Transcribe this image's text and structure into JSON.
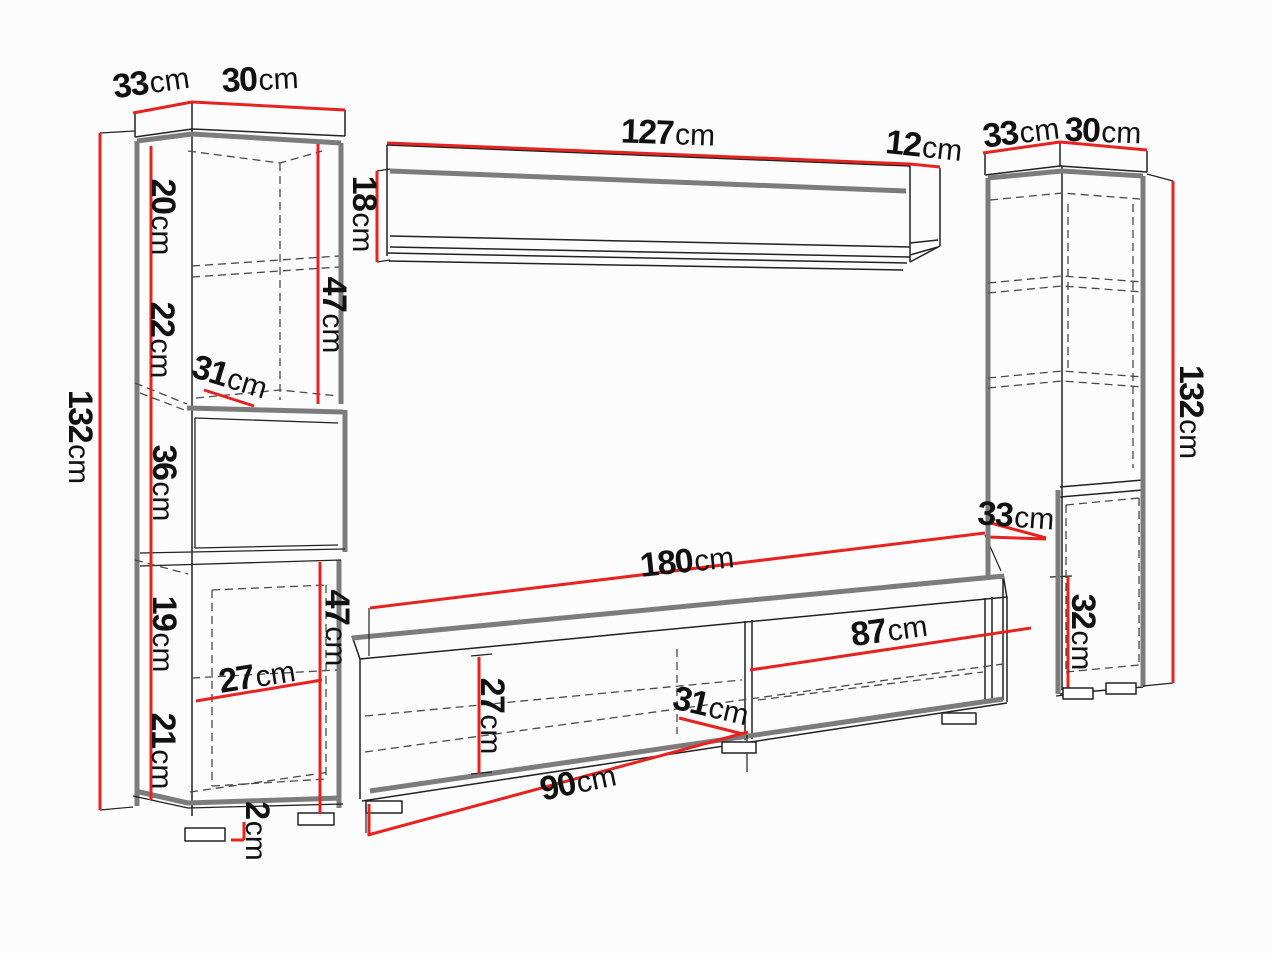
{
  "diagram": {
    "description": "Wall unit furniture dimension drawing",
    "colors": {
      "dimension_line": "#e8231f",
      "outline": "#222222",
      "shadow_edge": "#7c7c7c",
      "background": "#fcfcfc"
    }
  },
  "labels": {
    "left": {
      "top_depth": {
        "value": "33",
        "unit": "cm"
      },
      "top_width": {
        "value": "30",
        "unit": "cm"
      },
      "height": {
        "value": "132",
        "unit": "cm"
      },
      "shelf20": {
        "value": "20",
        "unit": "cm"
      },
      "shelf22": {
        "value": "22",
        "unit": "cm"
      },
      "depth31": {
        "value": "31",
        "unit": "cm"
      },
      "shelf36": {
        "value": "36",
        "unit": "cm"
      },
      "upper47": {
        "value": "47",
        "unit": "cm"
      },
      "shelf19": {
        "value": "19",
        "unit": "cm"
      },
      "depth27": {
        "value": "27",
        "unit": "cm"
      },
      "shelf21": {
        "value": "21",
        "unit": "cm"
      },
      "lower47": {
        "value": "47",
        "unit": "cm"
      },
      "plinth2": {
        "value": "2",
        "unit": "cm"
      }
    },
    "shelf": {
      "width127": {
        "value": "127",
        "unit": "cm"
      },
      "depth12": {
        "value": "12",
        "unit": "cm"
      },
      "height18": {
        "value": "18",
        "unit": "cm"
      }
    },
    "stand": {
      "width180": {
        "value": "180",
        "unit": "cm"
      },
      "height27": {
        "value": "27",
        "unit": "cm"
      },
      "inner87": {
        "value": "87",
        "unit": "cm"
      },
      "depth31": {
        "value": "31",
        "unit": "cm"
      },
      "door90": {
        "value": "90",
        "unit": "cm"
      }
    },
    "right": {
      "top_depth": {
        "value": "33",
        "unit": "cm"
      },
      "top_width": {
        "value": "30",
        "unit": "cm"
      },
      "height": {
        "value": "132",
        "unit": "cm"
      },
      "lower_depth": {
        "value": "33",
        "unit": "cm"
      },
      "lower_height": {
        "value": "32",
        "unit": "cm"
      }
    }
  }
}
